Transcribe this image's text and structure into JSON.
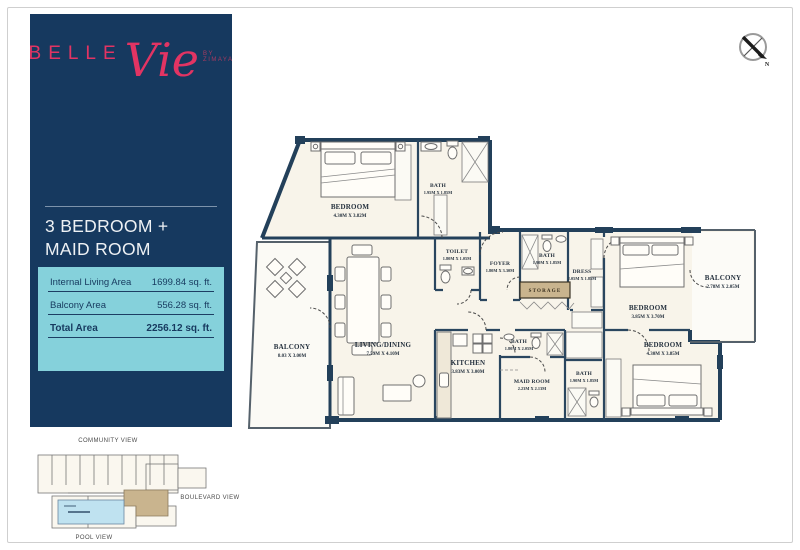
{
  "theme": {
    "sidebar_navy": "#16395f",
    "brand_pink": "#e23463",
    "panel_cyan": "#85d1db",
    "wall_color": "#23405a",
    "room_cream": "#f8f4ea",
    "highlight_tan": "#c9b48e",
    "pool_blue": "#bfe2f0"
  },
  "sidebar": {
    "logo": {
      "word": "BELLE",
      "script": "Vie",
      "byline": "BY ZIMAYA"
    },
    "unit_title_line1": "3 BEDROOM +",
    "unit_title_line2": "MAID ROOM",
    "areas": [
      {
        "label": "Internal Living Area",
        "value": "1699.84 sq. ft."
      },
      {
        "label": "Balcony Area",
        "value": "556.28 sq. ft."
      },
      {
        "label": "Total Area",
        "value": "2256.12 sq. ft."
      }
    ]
  },
  "compass": {
    "label": "N"
  },
  "rooms": {
    "bedroom1": {
      "name": "BEDROOM",
      "dims": "4.30M X 3.82M"
    },
    "bath1": {
      "name": "BATH",
      "dims": "1.95M X 1.85M"
    },
    "toilet": {
      "name": "TOILET",
      "dims": "1.80M X 1.05M"
    },
    "foyer": {
      "name": "FOYER",
      "dims": "1.80M X 3.30M"
    },
    "bath2": {
      "name": "BATH",
      "dims": "1.90M X 1.85M"
    },
    "storage": {
      "name": "STORAGE"
    },
    "dress": {
      "name": "DRESS",
      "dims": "2.05M X 1.85M"
    },
    "bedroom2": {
      "name": "BEDROOM",
      "dims": "3.85M X 3.70M"
    },
    "balcony2": {
      "name": "BALCONY",
      "dims": "2.78M X 2.05M"
    },
    "bedroom3": {
      "name": "BEDROOM",
      "dims": "4.30M X 3.85M"
    },
    "bath3": {
      "name": "BATH",
      "dims": "1.90M X 1.85M"
    },
    "maid": {
      "name": "MAID ROOM",
      "dims": "2.23M X 2.13M"
    },
    "bath4": {
      "name": "BATH",
      "dims": "1.80M X 2.05M"
    },
    "kitchen": {
      "name": "KITCHEN",
      "dims": "3.83M X 3.00M"
    },
    "living": {
      "name": "LIVING/DINING",
      "dims": "7.59M X 4.10M"
    },
    "balcony1": {
      "name": "BALCONY",
      "dims": "8.03 X 3.00M"
    }
  },
  "siteplan": {
    "community": "COMMUNITY VIEW",
    "boulevard": "BOULEVARD VIEW",
    "pool": "POOL VIEW"
  }
}
